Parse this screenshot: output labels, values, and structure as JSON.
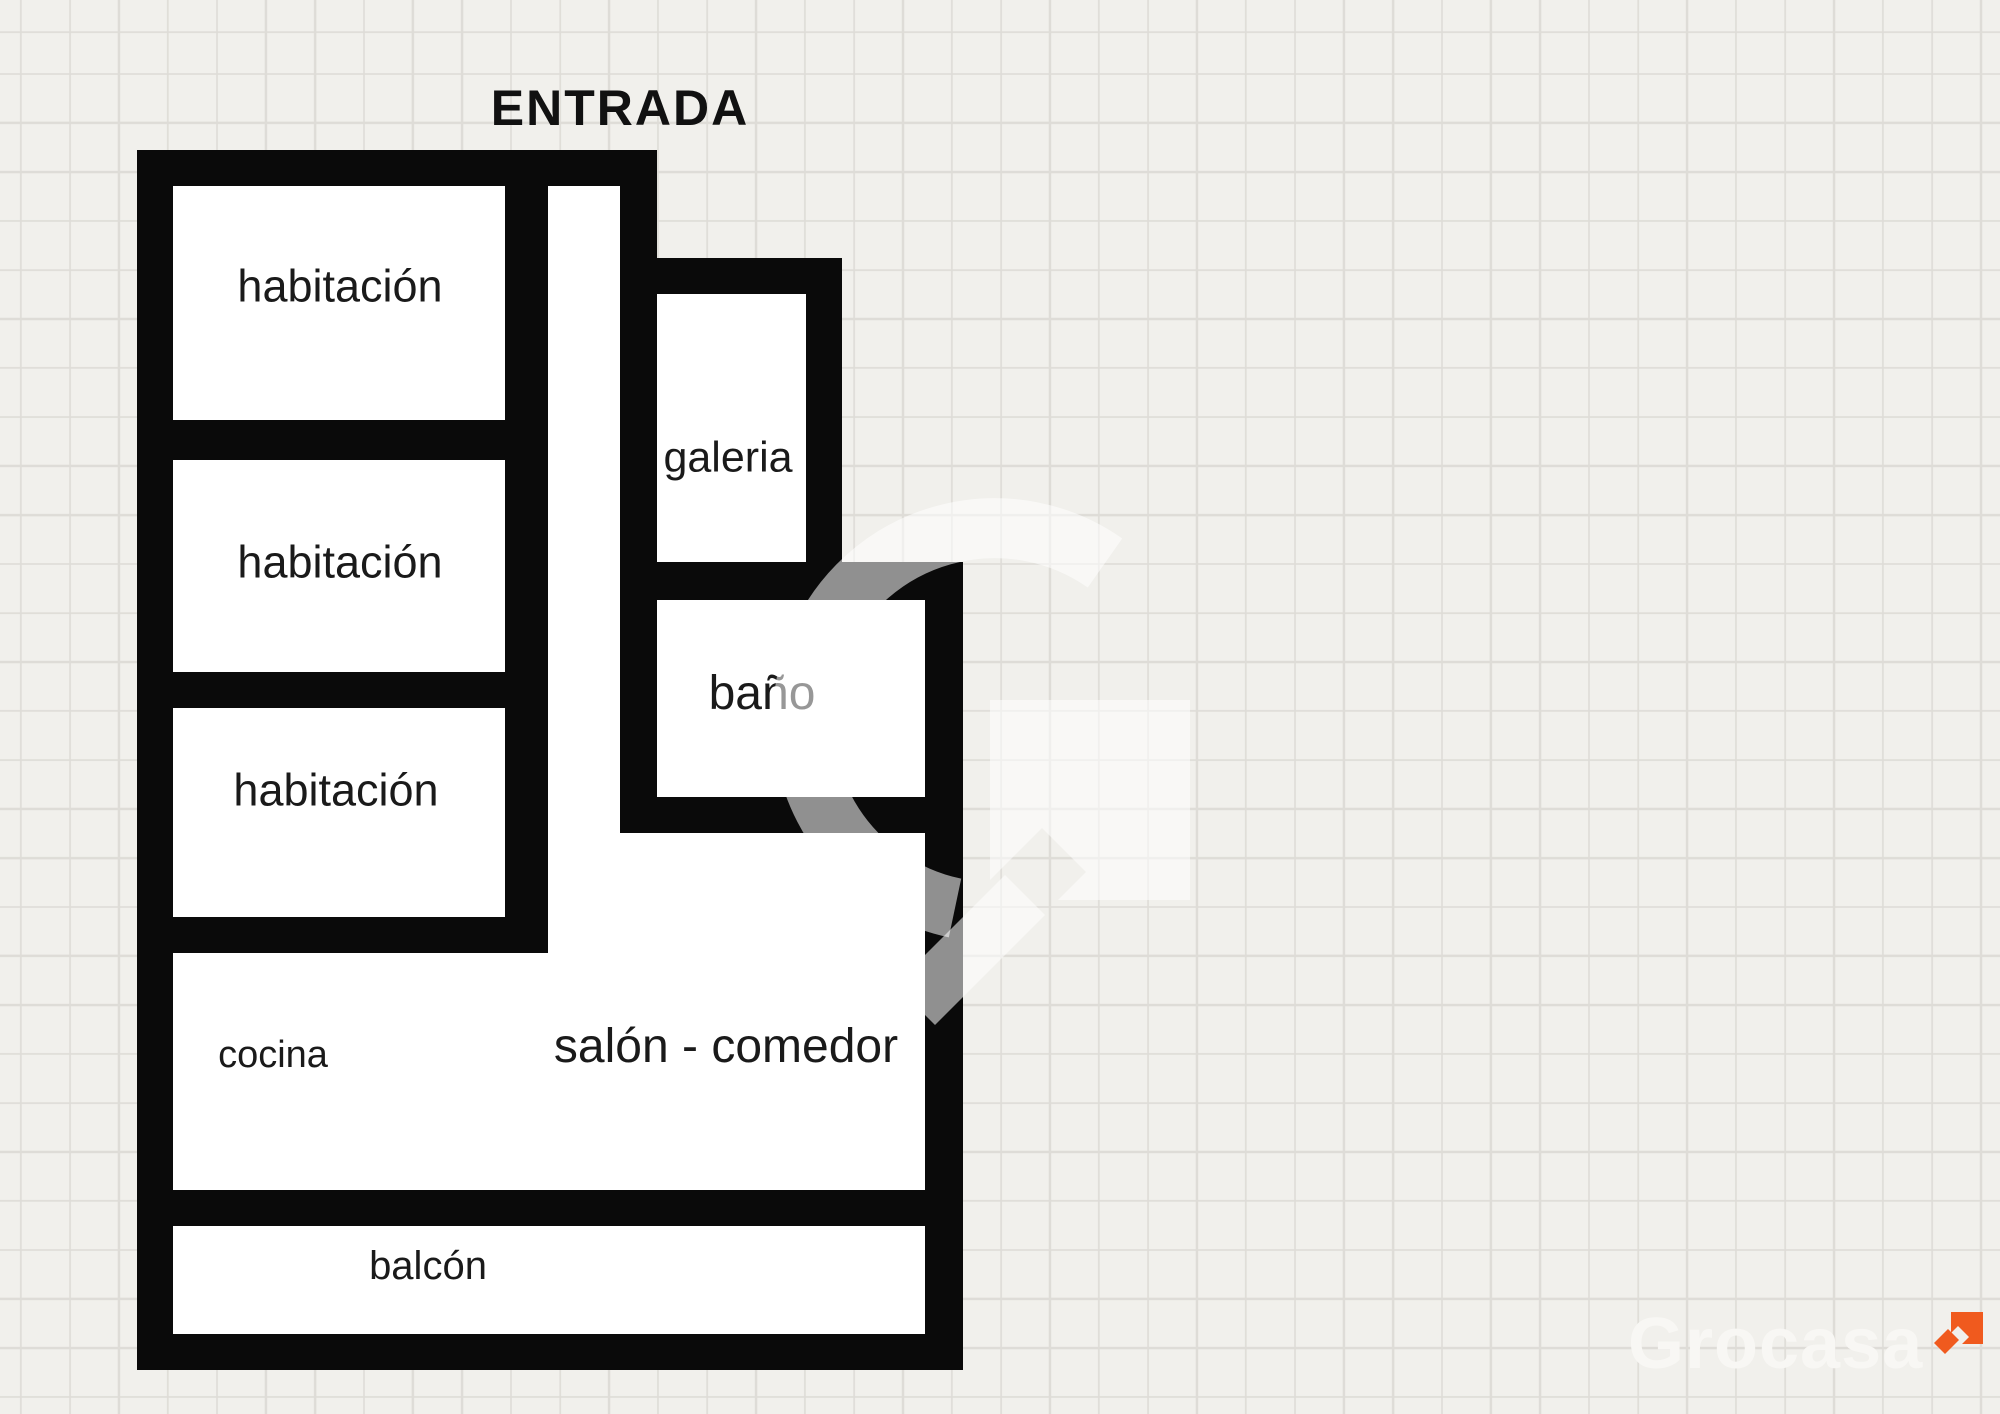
{
  "plan": {
    "entrance_label": "ENTRADA",
    "rooms": [
      {
        "name": "habitacion-1",
        "label": "habitación"
      },
      {
        "name": "habitacion-2",
        "label": "habitación"
      },
      {
        "name": "habitacion-3",
        "label": "habitación"
      },
      {
        "name": "galeria",
        "label": "galeria"
      },
      {
        "name": "bano",
        "label": "baño"
      },
      {
        "name": "cocina",
        "label": "cocina"
      },
      {
        "name": "salon-comedor",
        "label": "salón - comedor"
      },
      {
        "name": "balcon",
        "label": "balcón"
      }
    ]
  },
  "branding": {
    "logo_text": "Grocasa",
    "arrow_color": "#F05A1E",
    "logo_text_color": "#F8F7F4"
  },
  "colors": {
    "background": "#F1F0EC",
    "grid_line": "#DEDCD7",
    "wall": "#0A0A0A",
    "room_fill": "#FFFFFF",
    "label_text": "#1A1A1A",
    "watermark": "rgba(255,255,255,0.55)"
  }
}
